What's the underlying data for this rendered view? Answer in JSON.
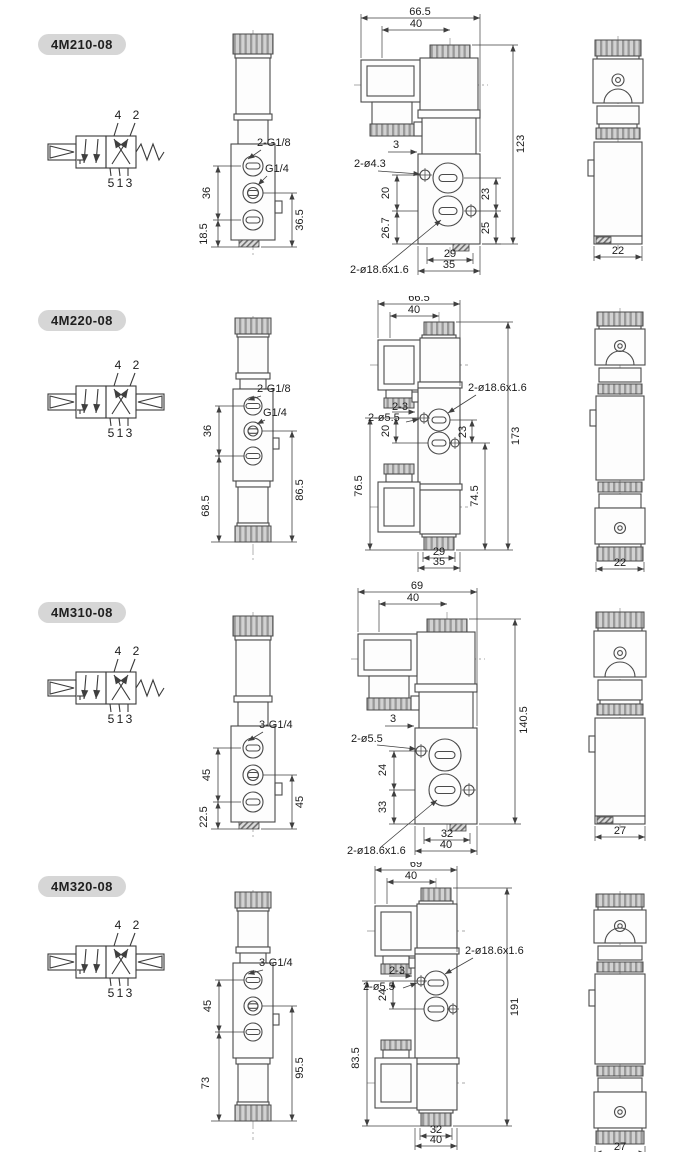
{
  "ports": {
    "top": [
      "4",
      "2"
    ],
    "bottom": [
      "5",
      "1",
      "3"
    ]
  },
  "theme": {
    "line": "#4a4a4a",
    "badge_bg": "#d6d6d6",
    "paper": "#ffffff"
  },
  "models": [
    {
      "name": "4M210-08",
      "symbol_type": "single-solenoid-spring-return",
      "front": {
        "label_top": "2-G1/8",
        "label_mid": "G1/4",
        "span": "36",
        "bottom": "18.5",
        "right": "36.5"
      },
      "side": {
        "width": "66.5",
        "coil": "40",
        "height": "123",
        "offset": "3",
        "holes": "2-ø4.3",
        "l1": "20",
        "l2": "26.7",
        "r1": "23",
        "r2": "25",
        "b1": "29",
        "b2": "35",
        "recess": "2-ø18.6x1.6"
      },
      "right": {
        "depth": "22"
      }
    },
    {
      "name": "4M220-08",
      "symbol_type": "double-solenoid",
      "front": {
        "label_top": "2-G1/8",
        "label_mid": "G1/4",
        "span": "36",
        "bottom": "68.5",
        "right": "86.5"
      },
      "side": {
        "width": "66.5",
        "coil": "40",
        "height": "173",
        "offset": "2-3",
        "holes": "2-ø5.5",
        "l1": "20",
        "l2": "76.5",
        "r1": "23",
        "r2": "74.5",
        "b1": "29",
        "b2": "35",
        "recess": "2-ø18.6x1.6"
      },
      "right": {
        "depth": "22"
      }
    },
    {
      "name": "4M310-08",
      "symbol_type": "single-solenoid-spring-return",
      "front": {
        "label_top": "3-G1/4",
        "span": "45",
        "bottom": "22.5",
        "right": "45"
      },
      "side": {
        "width": "69",
        "coil": "40",
        "height": "140.5",
        "offset": "3",
        "holes": "2-ø5.5",
        "l1": "24",
        "l2": "33",
        "b1": "32",
        "b2": "40",
        "recess": "2-ø18.6x1.6"
      },
      "right": {
        "depth": "27"
      }
    },
    {
      "name": "4M320-08",
      "symbol_type": "double-solenoid",
      "front": {
        "label_top": "3-G1/4",
        "span": "45",
        "bottom": "73",
        "right": "95.5"
      },
      "side": {
        "width": "69",
        "coil": "40",
        "height": "191",
        "offset": "2-3",
        "holes": "2-ø5.5",
        "l1": "24",
        "l2": "83.5",
        "b1": "32",
        "b2": "40",
        "recess": "2-ø18.6x1.6"
      },
      "right": {
        "depth": "27"
      }
    }
  ]
}
